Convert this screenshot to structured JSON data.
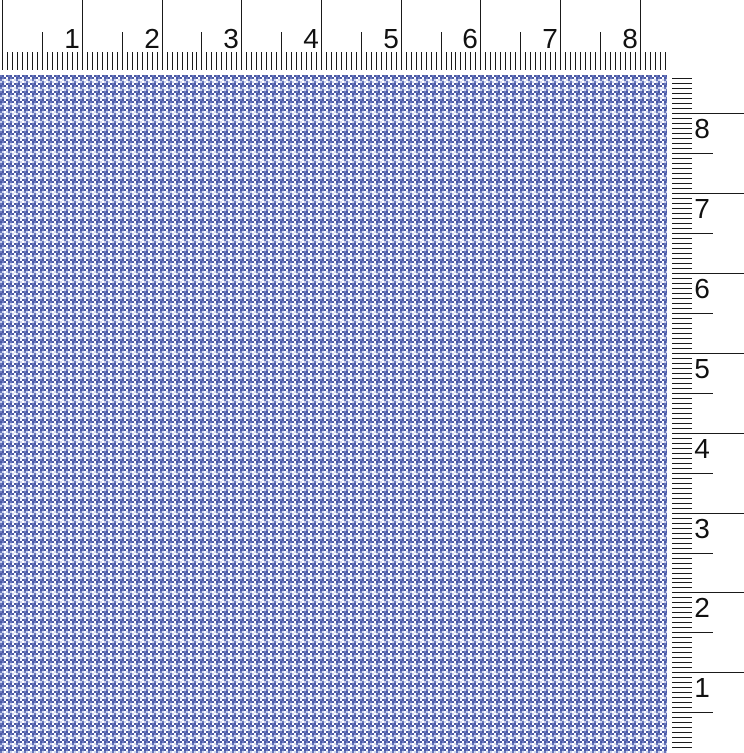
{
  "window": {
    "width": 744,
    "height": 753,
    "background": "#ffffff"
  },
  "horizontal_ruler": {
    "orientation": "horizontal",
    "unit": "inches",
    "labels": [
      "1",
      "2",
      "3",
      "4",
      "5",
      "6",
      "7",
      "8"
    ],
    "divisions_per_unit": 16,
    "tick_color": "#1a1a1a",
    "text_color": "#111111"
  },
  "vertical_ruler": {
    "orientation": "vertical",
    "unit": "inches",
    "labels_top_to_bottom": [
      "8",
      "7",
      "6",
      "5",
      "4",
      "3",
      "2",
      "1"
    ],
    "divisions_per_unit": 16,
    "tick_color": "#1a1a1a",
    "text_color": "#111111"
  },
  "fabric": {
    "colors": {
      "W": "#ffffff",
      "L": "#cdd4ee",
      "M": "#6877bd",
      "D": "#4a58a4"
    },
    "tile": [
      "MMDDWWDD",
      "MMDDWWDD",
      "DDMMDDWW",
      "DDMMDDWW",
      "MMLLWWLL",
      "MMLLWWLL",
      "LLMMLLWW",
      "LLMMLLWW"
    ]
  }
}
